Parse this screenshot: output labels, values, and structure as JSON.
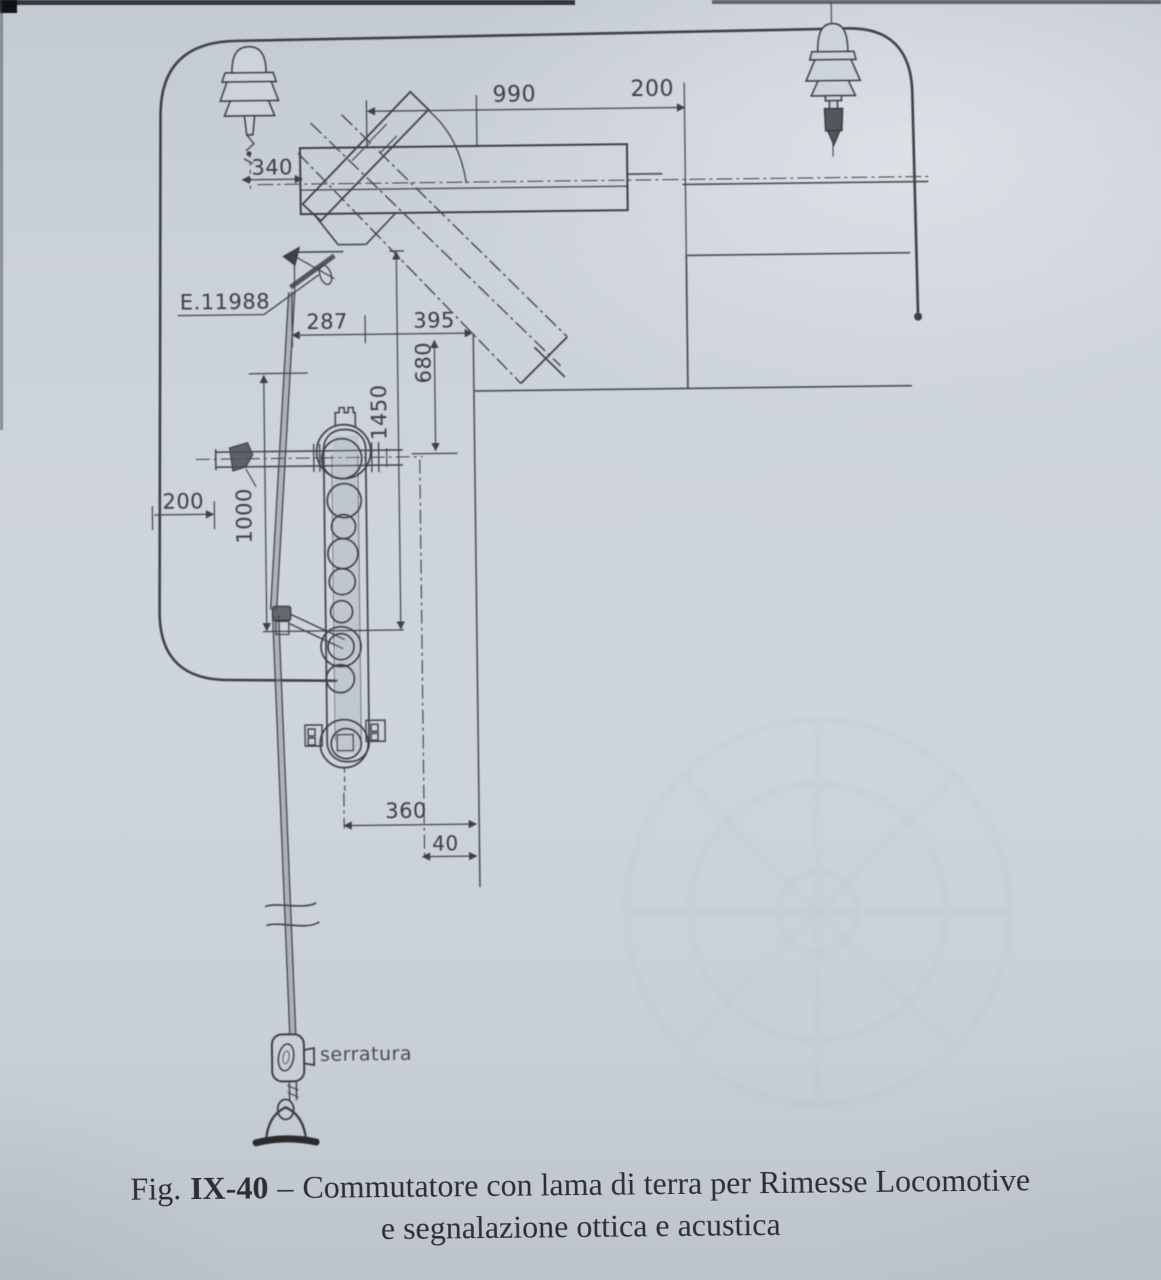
{
  "scan": {
    "paper_color": "#cdd3da",
    "ink_color": "#3e4046"
  },
  "drawing": {
    "reference_label": "E.11988",
    "lock_label": "serratura",
    "dimensions": {
      "top_span": "990",
      "top_right_offset": "200",
      "insulator_offset": "340",
      "pivot_left": "287",
      "pivot_right": "395",
      "vertical_drop": "680",
      "blade_length": "1450",
      "frame_to_rod": "200",
      "rod_length": "1000",
      "base_span": "360",
      "base_offset": "40"
    }
  },
  "caption": {
    "fig_prefix": "Fig.",
    "fig_number": "IX-40",
    "separator": "–",
    "line1": "Commutatore con lama di terra per Rimesse Locomotive",
    "line2": "e segnalazione ottica e acustica"
  }
}
